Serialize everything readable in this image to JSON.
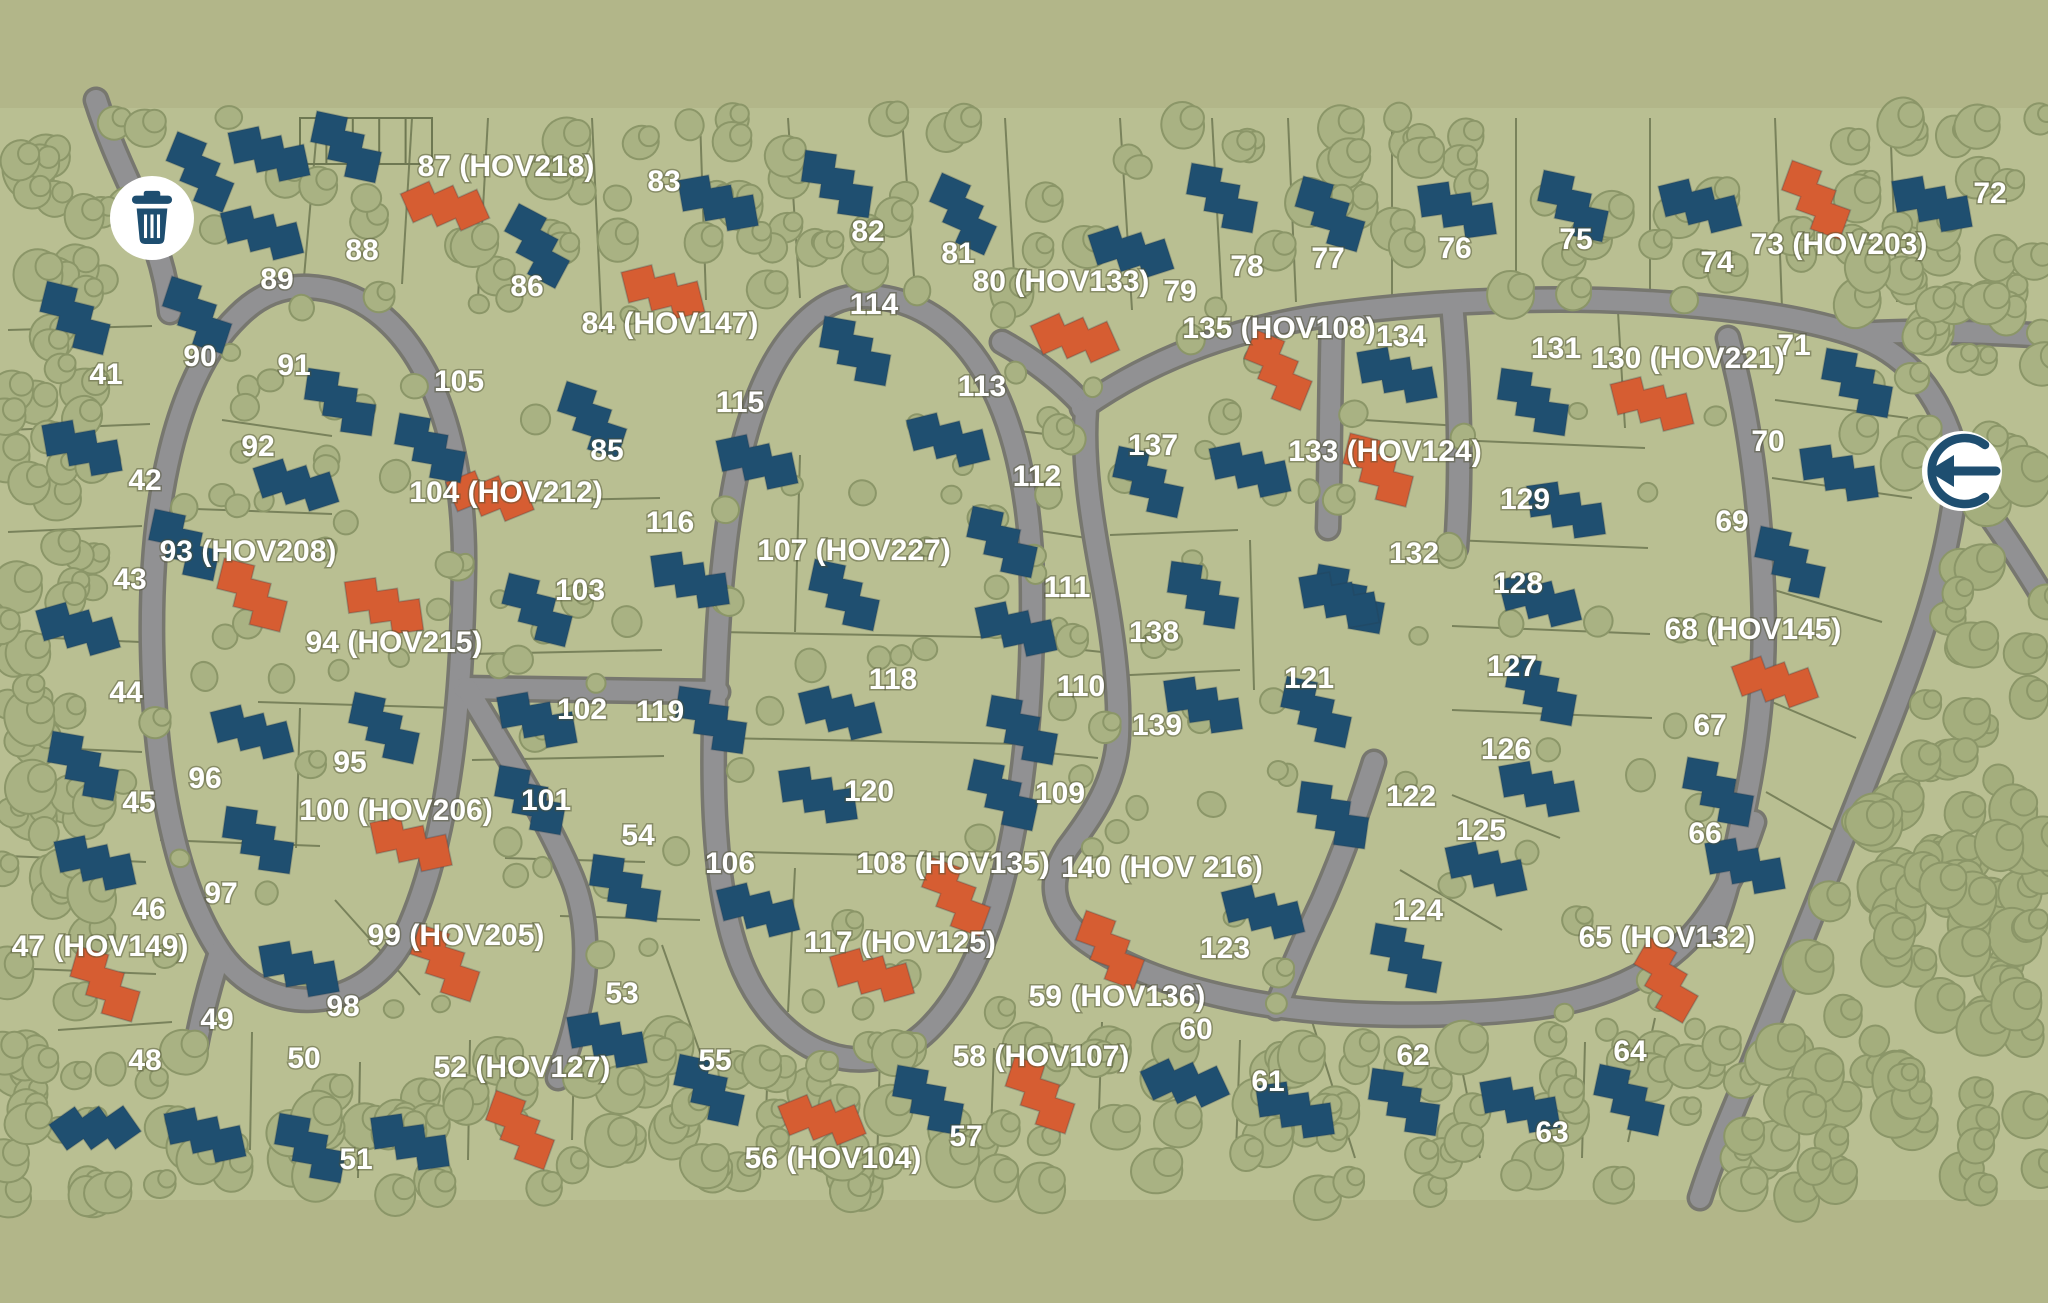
{
  "meta": {
    "title": "Residential community site plan map"
  },
  "palette": {
    "strip": "#b2b689",
    "land": "#b9bf92",
    "road_fill": "#919193",
    "road_casing": "#77776f",
    "lot_line": "#6e7852",
    "tree_fill": "#a9b283",
    "tree_stroke": "#8b9668",
    "forest_fill": "#a4ae7d",
    "house_blue": "#1f4f70",
    "house_orange": "#d65d32",
    "icon_navy": "#1e4e70",
    "label_white": "#ffffff"
  },
  "icons": {
    "trash": {
      "x": 152,
      "y": 218,
      "r": 42,
      "name": "trash-icon"
    },
    "entrance": {
      "x": 1962,
      "y": 471,
      "r": 40,
      "name": "entrance-arrow-icon"
    }
  },
  "structure": {
    "x": 300,
    "y": 118,
    "w": 132,
    "h": 46,
    "cols": 5
  },
  "labels": [
    [
      106,
      376,
      "41"
    ],
    [
      145,
      482,
      "42"
    ],
    [
      130,
      581,
      "43"
    ],
    [
      126,
      694,
      "44"
    ],
    [
      139,
      804,
      "45"
    ],
    [
      149,
      911,
      "46"
    ],
    [
      100,
      948,
      "47 (HOV149)"
    ],
    [
      145,
      1062,
      "48"
    ],
    [
      217,
      1021,
      "49"
    ],
    [
      304,
      1060,
      "50"
    ],
    [
      356,
      1161,
      "51"
    ],
    [
      522,
      1069,
      "52 (HOV127)"
    ],
    [
      622,
      995,
      "53"
    ],
    [
      638,
      837,
      "54"
    ],
    [
      715,
      1062,
      "55"
    ],
    [
      833,
      1160,
      "56 (HOV104)"
    ],
    [
      966,
      1138,
      "57"
    ],
    [
      1041,
      1058,
      "58 (HOV107)"
    ],
    [
      1117,
      998,
      "59 (HOV136)"
    ],
    [
      1196,
      1031,
      "60"
    ],
    [
      1268,
      1083,
      "61"
    ],
    [
      1413,
      1057,
      "62"
    ],
    [
      1552,
      1134,
      "63"
    ],
    [
      1630,
      1053,
      "64"
    ],
    [
      1667,
      939,
      "65 (HOV132)"
    ],
    [
      1705,
      835,
      "66"
    ],
    [
      1710,
      727,
      "67"
    ],
    [
      1753,
      631,
      "68 (HOV145)"
    ],
    [
      1732,
      523,
      "69"
    ],
    [
      1768,
      443,
      "70"
    ],
    [
      1794,
      347,
      "71"
    ],
    [
      1990,
      195,
      "72"
    ],
    [
      1839,
      246,
      "73 (HOV203)"
    ],
    [
      1717,
      264,
      "74"
    ],
    [
      1576,
      241,
      "75"
    ],
    [
      1455,
      250,
      "76"
    ],
    [
      1328,
      260,
      "77"
    ],
    [
      1247,
      268,
      "78"
    ],
    [
      1180,
      293,
      "79"
    ],
    [
      1061,
      283,
      "80 (HOV133)"
    ],
    [
      958,
      255,
      "81"
    ],
    [
      868,
      233,
      "82"
    ],
    [
      664,
      183,
      "83"
    ],
    [
      670,
      325,
      "84 (HOV147)"
    ],
    [
      607,
      452,
      "85"
    ],
    [
      527,
      288,
      "86"
    ],
    [
      506,
      168,
      "87 (HOV218)"
    ],
    [
      362,
      252,
      "88"
    ],
    [
      277,
      281,
      "89"
    ],
    [
      200,
      358,
      "90"
    ],
    [
      294,
      367,
      "91"
    ],
    [
      258,
      448,
      "92"
    ],
    [
      248,
      553,
      "93 (HOV208)"
    ],
    [
      394,
      644,
      "94 (HOV215)"
    ],
    [
      350,
      764,
      "95"
    ],
    [
      205,
      780,
      "96"
    ],
    [
      221,
      895,
      "97"
    ],
    [
      343,
      1008,
      "98"
    ],
    [
      456,
      937,
      "99 (HOV205)"
    ],
    [
      396,
      812,
      "100 (HOV206)"
    ],
    [
      546,
      802,
      "101"
    ],
    [
      582,
      711,
      "102"
    ],
    [
      580,
      592,
      "103"
    ],
    [
      506,
      494,
      "104 (HOV212)"
    ],
    [
      459,
      383,
      "105"
    ],
    [
      730,
      865,
      "106"
    ],
    [
      854,
      552,
      "107 (HOV227)"
    ],
    [
      953,
      865,
      "108 (HOV135)"
    ],
    [
      1060,
      795,
      "109"
    ],
    [
      1081,
      688,
      "110"
    ],
    [
      1067,
      589,
      "111"
    ],
    [
      1037,
      478,
      "112"
    ],
    [
      982,
      388,
      "113"
    ],
    [
      874,
      306,
      "114"
    ],
    [
      740,
      404,
      "115"
    ],
    [
      670,
      524,
      "116"
    ],
    [
      900,
      944,
      "117 (HOV125)"
    ],
    [
      893,
      681,
      "118"
    ],
    [
      660,
      713,
      "119"
    ],
    [
      869,
      793,
      "120"
    ],
    [
      1309,
      680,
      "121"
    ],
    [
      1411,
      798,
      "122"
    ],
    [
      1225,
      950,
      "123"
    ],
    [
      1418,
      912,
      "124"
    ],
    [
      1481,
      832,
      "125"
    ],
    [
      1506,
      751,
      "126"
    ],
    [
      1512,
      668,
      "127"
    ],
    [
      1518,
      585,
      "128"
    ],
    [
      1525,
      501,
      "129"
    ],
    [
      1688,
      360,
      "130  (HOV221)"
    ],
    [
      1556,
      350,
      "131"
    ],
    [
      1414,
      555,
      "132"
    ],
    [
      1385,
      453,
      "133 (HOV124)"
    ],
    [
      1401,
      338,
      "134"
    ],
    [
      1279,
      330,
      "135 (HOV108)"
    ],
    [
      1153,
      447,
      "137"
    ],
    [
      1154,
      634,
      "138"
    ],
    [
      1157,
      727,
      "139"
    ],
    [
      1162,
      869,
      "140 (HOV 216)"
    ]
  ],
  "houses": [
    [
      200,
      172,
      22,
      "b"
    ],
    [
      269,
      154,
      -12,
      "b"
    ],
    [
      346,
      147,
      12,
      "b"
    ],
    [
      445,
      206,
      -24,
      "o"
    ],
    [
      537,
      246,
      28,
      "b"
    ],
    [
      663,
      292,
      -14,
      "o"
    ],
    [
      592,
      420,
      18,
      "b"
    ],
    [
      718,
      203,
      -10,
      "b"
    ],
    [
      837,
      184,
      8,
      "b"
    ],
    [
      963,
      214,
      24,
      "b"
    ],
    [
      1131,
      252,
      -18,
      "b"
    ],
    [
      1222,
      198,
      10,
      "b"
    ],
    [
      1075,
      338,
      -24,
      "o"
    ],
    [
      1330,
      214,
      16,
      "b"
    ],
    [
      1457,
      210,
      -8,
      "b"
    ],
    [
      1573,
      206,
      12,
      "b"
    ],
    [
      1700,
      206,
      -14,
      "b"
    ],
    [
      1816,
      200,
      20,
      "o"
    ],
    [
      1932,
      204,
      -10,
      "b"
    ],
    [
      75,
      318,
      14,
      "b"
    ],
    [
      82,
      448,
      -10,
      "b"
    ],
    [
      184,
      545,
      12,
      "b"
    ],
    [
      78,
      629,
      -16,
      "b"
    ],
    [
      83,
      766,
      10,
      "b"
    ],
    [
      95,
      863,
      -12,
      "b"
    ],
    [
      105,
      984,
      16,
      "o"
    ],
    [
      95,
      1128,
      -35,
      "b"
    ],
    [
      197,
      315,
      18,
      "b"
    ],
    [
      262,
      233,
      -14,
      "b"
    ],
    [
      340,
      402,
      8,
      "b"
    ],
    [
      296,
      485,
      -18,
      "b"
    ],
    [
      252,
      595,
      14,
      "o"
    ],
    [
      384,
      606,
      -8,
      "o"
    ],
    [
      384,
      728,
      12,
      "b"
    ],
    [
      252,
      732,
      -14,
      "b"
    ],
    [
      258,
      840,
      8,
      "b"
    ],
    [
      299,
      969,
      -10,
      "b"
    ],
    [
      445,
      963,
      18,
      "o"
    ],
    [
      411,
      844,
      -12,
      "o"
    ],
    [
      530,
      800,
      10,
      "b"
    ],
    [
      537,
      720,
      -10,
      "b"
    ],
    [
      537,
      610,
      14,
      "b"
    ],
    [
      490,
      496,
      -22,
      "o"
    ],
    [
      430,
      448,
      10,
      "b"
    ],
    [
      757,
      462,
      -12,
      "b"
    ],
    [
      855,
      351,
      10,
      "b"
    ],
    [
      948,
      440,
      -14,
      "b"
    ],
    [
      1002,
      542,
      12,
      "b"
    ],
    [
      690,
      580,
      -8,
      "b"
    ],
    [
      844,
      595,
      12,
      "b"
    ],
    [
      1016,
      629,
      -12,
      "b"
    ],
    [
      711,
      720,
      8,
      "b"
    ],
    [
      840,
      713,
      -14,
      "b"
    ],
    [
      1022,
      730,
      10,
      "b"
    ],
    [
      818,
      795,
      -8,
      "b"
    ],
    [
      1003,
      795,
      12,
      "b"
    ],
    [
      758,
      910,
      -14,
      "b"
    ],
    [
      956,
      897,
      20,
      "o"
    ],
    [
      872,
      975,
      -16,
      "o"
    ],
    [
      1278,
      370,
      22,
      "o"
    ],
    [
      1397,
      375,
      -10,
      "b"
    ],
    [
      1533,
      402,
      8,
      "b"
    ],
    [
      1652,
      404,
      -14,
      "o"
    ],
    [
      1857,
      383,
      10,
      "b"
    ],
    [
      1839,
      473,
      -8,
      "b"
    ],
    [
      1790,
      562,
      12,
      "b"
    ],
    [
      1775,
      682,
      -20,
      "o"
    ],
    [
      1718,
      792,
      10,
      "b"
    ],
    [
      1745,
      866,
      -10,
      "b"
    ],
    [
      1666,
      980,
      30,
      "o"
    ],
    [
      1148,
      482,
      12,
      "b"
    ],
    [
      1250,
      470,
      -12,
      "b"
    ],
    [
      1378,
      470,
      14,
      "o"
    ],
    [
      1566,
      510,
      -8,
      "b"
    ],
    [
      1349,
      599,
      10,
      "b"
    ],
    [
      1540,
      600,
      -14,
      "b"
    ],
    [
      1541,
      691,
      10,
      "b"
    ],
    [
      1539,
      789,
      -10,
      "b"
    ],
    [
      1203,
      595,
      8,
      "b"
    ],
    [
      1339,
      600,
      -10,
      "b"
    ],
    [
      1316,
      712,
      12,
      "b"
    ],
    [
      1203,
      705,
      -8,
      "b"
    ],
    [
      1333,
      815,
      8,
      "b"
    ],
    [
      1486,
      869,
      -12,
      "b"
    ],
    [
      1406,
      958,
      10,
      "b"
    ],
    [
      1263,
      912,
      -14,
      "b"
    ],
    [
      1110,
      950,
      20,
      "o"
    ],
    [
      1185,
      1083,
      -25,
      "b"
    ],
    [
      709,
      1090,
      12,
      "b"
    ],
    [
      822,
      1120,
      -22,
      "o"
    ],
    [
      928,
      1100,
      10,
      "b"
    ],
    [
      1040,
      1095,
      18,
      "o"
    ],
    [
      1295,
      1110,
      -8,
      "b"
    ],
    [
      1404,
      1102,
      8,
      "b"
    ],
    [
      1520,
      1105,
      -10,
      "b"
    ],
    [
      1629,
      1100,
      12,
      "b"
    ],
    [
      205,
      1135,
      -12,
      "b"
    ],
    [
      310,
      1148,
      10,
      "b"
    ],
    [
      410,
      1142,
      -8,
      "b"
    ],
    [
      520,
      1130,
      20,
      "o"
    ],
    [
      607,
      1040,
      -10,
      "b"
    ],
    [
      625,
      888,
      8,
      "b"
    ]
  ],
  "roads": [
    "M 96,100 C 124,188 162,232 170,312",
    "M 308,287 C 412,292 466,418 464,568 C 462,718 446,848 406,934 C 368,1014 268,1022 220,952 C 172,880 154,764 152,644 C 150,506 174,378 238,316 C 260,294 283,286 308,287 Z",
    "M 220,952 C 208,990 200,1022 194,1056",
    "M 464,688 L 718,692",
    "M 868,296 C 975,302 1030,420 1032,585 C 1034,755 1010,950 928,1030 C 868,1088 782,1056 744,970 C 714,902 711,795 715,698 C 720,520 742,392 796,332 C 820,304 843,295 868,296 Z",
    "M 1002,342 C 1038,362 1064,384 1084,406",
    "M 1082,408 C 1150,360 1230,330 1320,316 C 1420,302 1520,298 1600,300 C 1700,303 1800,315 1858,336 C 1915,357 1945,405 1958,462",
    "M 1855,334 C 1920,330 1990,332 2048,336",
    "M 1958,462 C 1952,560 1915,660 1872,765 C 1830,870 1785,985 1748,1075 C 1727,1125 1712,1160 1700,1198",
    "M 1962,478 C 1995,520 2022,562 2048,605",
    "M 1452,303 C 1459,380 1462,470 1456,548",
    "M 1332,318 C 1330,390 1330,460 1328,528",
    "M 1086,410 C 1082,462 1092,522 1102,576 C 1112,630 1120,686 1118,736 C 1116,782 1092,816 1068,848 C 1048,878 1050,908 1080,936 C 1128,974 1210,998 1290,1008 C 1372,1018 1462,1016 1532,1008 C 1612,998 1672,966 1706,918 C 1732,882 1744,852 1754,822",
    "M 1374,762 C 1362,800 1344,852 1322,902 C 1305,938 1290,972 1276,1008",
    "M 1728,338 C 1750,420 1760,505 1763,590 C 1766,665 1760,730 1746,800 C 1735,855 1726,900 1712,930",
    "M 468,690 C 510,760 548,820 572,878 C 590,922 588,975 576,1020 C 570,1046 564,1062 558,1078"
  ],
  "lot_lines": [
    "8 330 152 326",
    "8 430 150 424",
    "8 532 142 526",
    "8 636 140 642",
    "8 746 142 752",
    "8 856 146 862",
    "8 968 156 974",
    "58 1030 172 1022",
    "318 118 302 300",
    "412 118 402 284",
    "488 118 478 298",
    "592 118 602 332",
    "700 118 706 300",
    "788 118 800 298",
    "902 118 915 290",
    "1005 118 1015 292",
    "1120 118 1132 310",
    "1212 118 1222 302",
    "1288 118 1296 302",
    "1392 118 1392 308",
    "1516 118 1516 306",
    "1650 118 1650 304",
    "1775 118 1782 308",
    "1890 118 1897 302",
    "168 508 332 514",
    "222 420 332 436",
    "258 702 458 708",
    "300 708 296 848",
    "160 840 320 846",
    "335 900 420 995",
    "468 502 660 498",
    "470 654 662 650",
    "472 760 664 756",
    "505 858 645 862",
    "560 916 700 920",
    "720 632 1028 638",
    "722 738 1024 744",
    "800 455 795 632",
    "745 852 1005 858",
    "795 868 788 1012",
    "1010 430 1098 440",
    "1034 530 1100 540",
    "1036 645 1102 652",
    "1038 752 1098 758",
    "1110 535 1238 530",
    "1108 676 1240 670",
    "1250 540 1254 690",
    "1455 440 1645 448",
    "1452 540 1648 548",
    "1452 626 1650 634",
    "1452 710 1652 718",
    "1452 795 1560 838",
    "1400 870 1502 930",
    "1618 312 1625 428",
    "1332 418 1460 426",
    "1775 400 1908 418",
    "1772 478 1912 498",
    "1774 590 1882 622",
    "1772 702 1856 738",
    "1766 792 1836 832",
    "252 1032 250 1150",
    "360 1062 358 1178",
    "470 1040 468 1160",
    "575 1022 572 1140",
    "662 945 702 1058",
    "768 1060 764 1170",
    "880 1052 877 1168",
    "994 1048 990 1162",
    "1102 1022 1098 1140",
    "1240 1040 1236 1152",
    "1310 1015 1355 1158",
    "1455 1035 1480 1158",
    "1585 1042 1582 1158",
    "1655 1018 1628 1142"
  ],
  "tree_layers": [
    {
      "x0": 95,
      "y0": 116,
      "x1": 2040,
      "y1": 300,
      "n": 90,
      "rmin": 13,
      "rmax": 24,
      "kind": "belt"
    },
    {
      "x0": 0,
      "y0": 116,
      "x1": 95,
      "y1": 1198,
      "n": 70,
      "rmin": 14,
      "rmax": 26,
      "kind": "belt"
    },
    {
      "x0": 0,
      "y0": 1045,
      "x1": 1780,
      "y1": 1198,
      "n": 135,
      "rmin": 14,
      "rmax": 26,
      "kind": "belt"
    },
    {
      "x0": 1850,
      "y0": 116,
      "x1": 2048,
      "y1": 470,
      "n": 40,
      "rmin": 13,
      "rmax": 24,
      "kind": "belt"
    },
    {
      "x0": 1690,
      "y0": 470,
      "x1": 2048,
      "y1": 1198,
      "n": 170,
      "rmin": 14,
      "rmax": 28,
      "kind": "forest"
    },
    {
      "x0": 95,
      "y0": 300,
      "x1": 1720,
      "y1": 1050,
      "n": 150,
      "rmin": 9,
      "rmax": 16,
      "kind": "scatter"
    }
  ]
}
